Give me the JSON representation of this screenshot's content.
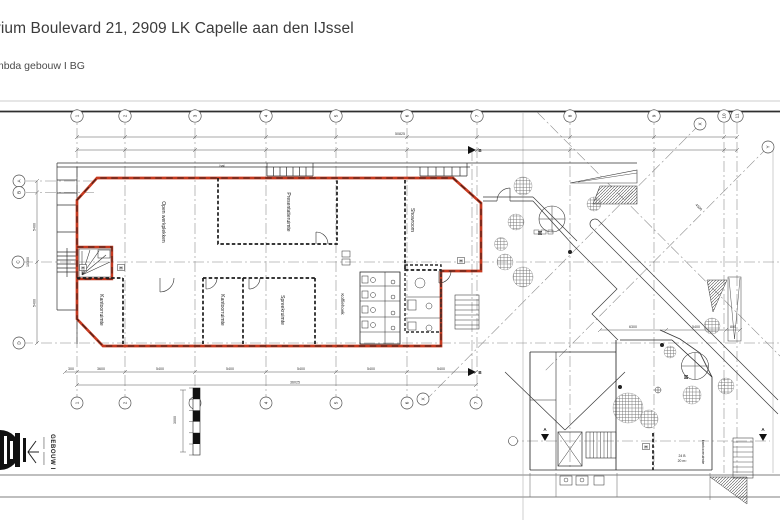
{
  "header": {
    "title": "vium Boulevard 21, 2909 LK Capelle aan den IJssel",
    "subtitle": "mbda gebouw I BG"
  },
  "colors": {
    "accent": "#c6391f",
    "wall": "#2b2b2b",
    "grid": "#808080"
  },
  "grid": {
    "top": [
      "1",
      "2",
      "3",
      "4",
      "5",
      "6",
      "7",
      "8",
      "9",
      "10",
      "11"
    ],
    "bottom": [
      "1",
      "2",
      "3",
      "4",
      "5",
      "6",
      "X",
      "7"
    ],
    "left": [
      "A",
      "B",
      "C",
      "D"
    ],
    "diag_x": "X",
    "diag_y": "Y"
  },
  "rooms": {
    "open_werkplekken": "Open werkplekken",
    "presentatieruimte": "Presentatieruimte",
    "showroom": "Showroom",
    "kantoorruimte1": "Kantoorruimte",
    "kantoorruimte2": "Kantoorruimte",
    "spreekruimte": "Spreekruimte",
    "koffiehoek": "Koffiehoek",
    "hal": "hal",
    "kantoorruimte3": "kantoorruimte",
    "unit_number": "24 B",
    "unit_area": "20 m²"
  },
  "dims": {
    "top_total": "50825",
    "bottom_total": "36025",
    "left_total": "10300",
    "left_sub1": "5400",
    "left_sub2": "5400",
    "bottom_sub": [
      "300",
      "3600",
      "5400",
      "5400",
      "5400",
      "5400",
      "5400"
    ],
    "right_sub": [
      "6300",
      "5400",
      "800"
    ],
    "diag": "4500",
    "scale_note": "3000"
  },
  "markers": {
    "hose": "H",
    "entrance": "M",
    "section_a": "A",
    "section_b": "B"
  },
  "titleblock": {
    "building": "GEBOUW I"
  }
}
